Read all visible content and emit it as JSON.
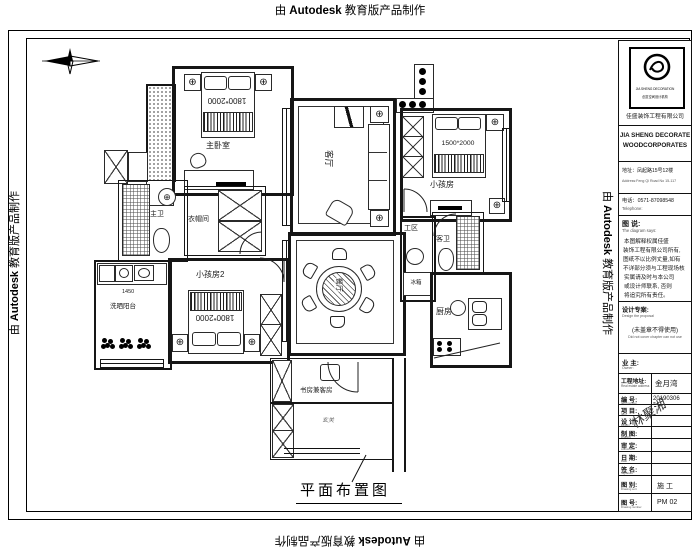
{
  "watermark": {
    "prefix": "由",
    "brand": "Autodesk",
    "suffix": "教育版产品制作"
  },
  "plan": {
    "title": "平面布置图"
  },
  "rooms": {
    "master_bedroom": "主卧室",
    "closet": "衣帽间",
    "master_bath": "主卫",
    "living": "客厅",
    "kids": "小孩房",
    "kids2": "小孩房2",
    "laundry": "洗晒阳台",
    "dining": "餐厅",
    "work_zone": "工区",
    "guest_bath": "客卫",
    "kitchen": "厨房",
    "study": "书房兼客房",
    "foyer": "玄关",
    "fridge": "冰箱"
  },
  "dims": {
    "master_bed": "1800*2000",
    "kids_bed": "1500*2000",
    "kids2_bed": "1800*2000",
    "laundry_width": "1450"
  },
  "titleblock": {
    "logo_sub1": "JIA SHENG DECORATION",
    "logo_sub2": "创意空间设计机构",
    "company_cn": "佳盛装饰工程有限公司",
    "company_en1": "JIA SHENG DECORATE",
    "company_en2": "WOODCORPORATES",
    "address_cn": "地址：凤起路15号12楼",
    "address_en": "Address:Feng Qi Road No 15-117",
    "phone_cn": "电话：0571-87098548",
    "phone_en": "Telephone:",
    "notes_title": "图 说:",
    "notes_subtitle": "The diagram says:",
    "notes": [
      "本图解释权属佳盛",
      "装饰工程有限公司所有,",
      "图纸不以比例丈量,如有",
      "不详部分须与工程现场核",
      "实属请及时与本公司",
      "或设计师联系, 否则",
      "将追究所有责任。"
    ],
    "design_label": "设计专案:",
    "design_sub": "Design the proposal",
    "stamp_note": "(未盖章不得使用)",
    "stamp_note_en": "Did not cover chapter can not use",
    "owner_label": "业 主:",
    "owner_sub": "Owner:",
    "site_label": "工程地址:",
    "site_sub": "Real estate address",
    "site_value": "金月湾",
    "signature": "林聚湘",
    "table": [
      {
        "label": "编 号:",
        "sub": "Item number",
        "value": "20190306"
      },
      {
        "label": "项 目:",
        "sub": "Item",
        "value": ""
      },
      {
        "label": "设 计:",
        "sub": "Design",
        "value": ""
      },
      {
        "label": "制 图:",
        "sub": "Drafting",
        "value": ""
      },
      {
        "label": "审 定:",
        "sub": "Authorized",
        "value": ""
      },
      {
        "label": "日 期:",
        "sub": "Date",
        "value": ""
      },
      {
        "label": "签 名:",
        "sub": "Signature",
        "value": ""
      },
      {
        "label": "图 别:",
        "sub": "Drawing sort",
        "value": "施 工"
      },
      {
        "label": "图 号:",
        "sub": "Drawing number",
        "value": "PM 02"
      }
    ]
  }
}
